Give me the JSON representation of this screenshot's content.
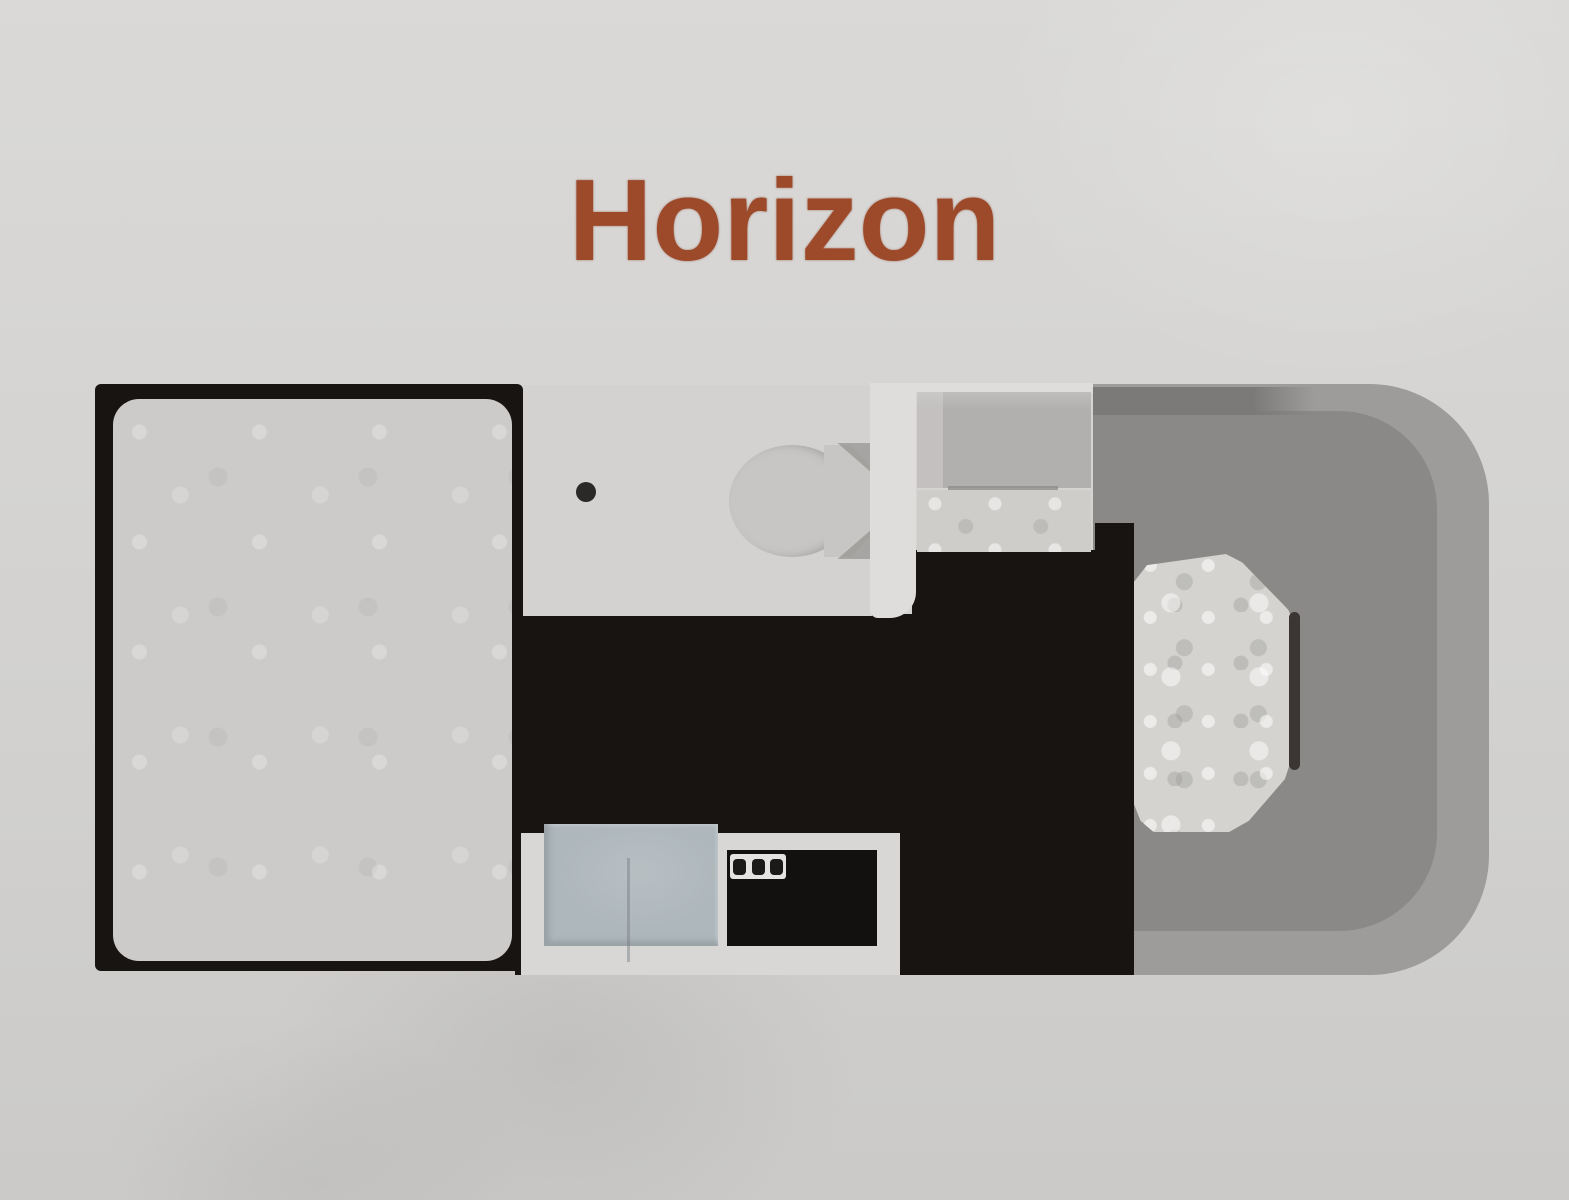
{
  "title": {
    "text": "Horizon"
  },
  "floorplan": {
    "model_name": "Horizon",
    "areas": [
      "bed",
      "bathroom-with-toilet-and-shower-drain",
      "wardrobe-cabinet",
      "galley-kitchen-with-sink-and-stove",
      "aisle-floor",
      "driver-cab-with-seat"
    ],
    "stove_knob_count": 3
  },
  "colors": {
    "page_bg": "#d2d1cf",
    "page_bg_light": "#dad9d7",
    "title": "#9d4a2b",
    "floor_black": "#171412",
    "bed_fill": "#cccbc9",
    "bathroom_floor": "#d3d2d0",
    "fixture_gray": "#c7c6c4",
    "shade_gray": "#8f8d8b",
    "drain": "#2b2927",
    "wall_white": "#dedddb",
    "cabinet_gray": "#b2b0af",
    "cabinet_light": "#cecdca",
    "cab_outer": "#9e9c9a",
    "cab_inner": "#8b8987",
    "cab_dash": "#7c7a78",
    "seat_fill": "#d4d3d0",
    "shadow_dark": "#3b3533",
    "unit_white": "#d8d7d5",
    "sink_blue": "#aeb7bb",
    "stove_black": "#131110",
    "knob_panel": "#e4e3e1",
    "knob": "#1c1a19"
  }
}
